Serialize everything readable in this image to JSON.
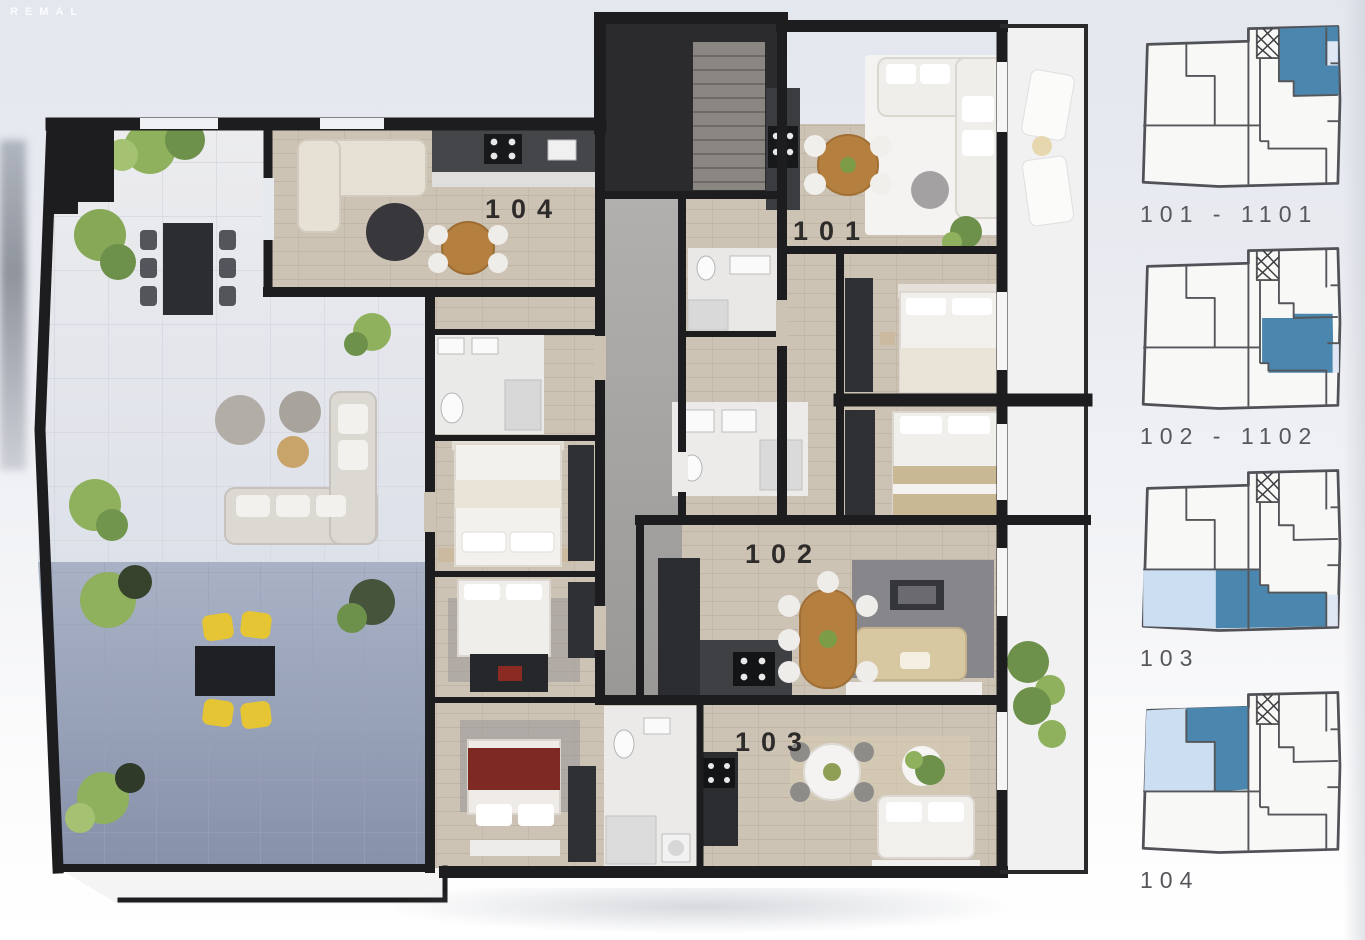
{
  "watermark": "REMAL",
  "main_plan": {
    "units": [
      {
        "id": "101",
        "label": "101"
      },
      {
        "id": "102",
        "label": "102"
      },
      {
        "id": "103",
        "label": "103"
      },
      {
        "id": "104",
        "label": "104"
      }
    ]
  },
  "sidebar": {
    "items": [
      {
        "id": "101-1101",
        "label": "101 - 1101"
      },
      {
        "id": "102-1102",
        "label": "102 - 1102"
      },
      {
        "id": "103",
        "label": "103"
      },
      {
        "id": "104",
        "label": "104"
      }
    ]
  },
  "colors": {
    "unit_highlight": "#4a86ad",
    "terrace_highlight": "#ccdff2",
    "balcony_highlight": "#dfe7f4",
    "wall": "#1d1d1f",
    "wood_floor": "#cdc3b5",
    "terrace_tile": "#8d99b2",
    "label_color": "#56575b"
  }
}
